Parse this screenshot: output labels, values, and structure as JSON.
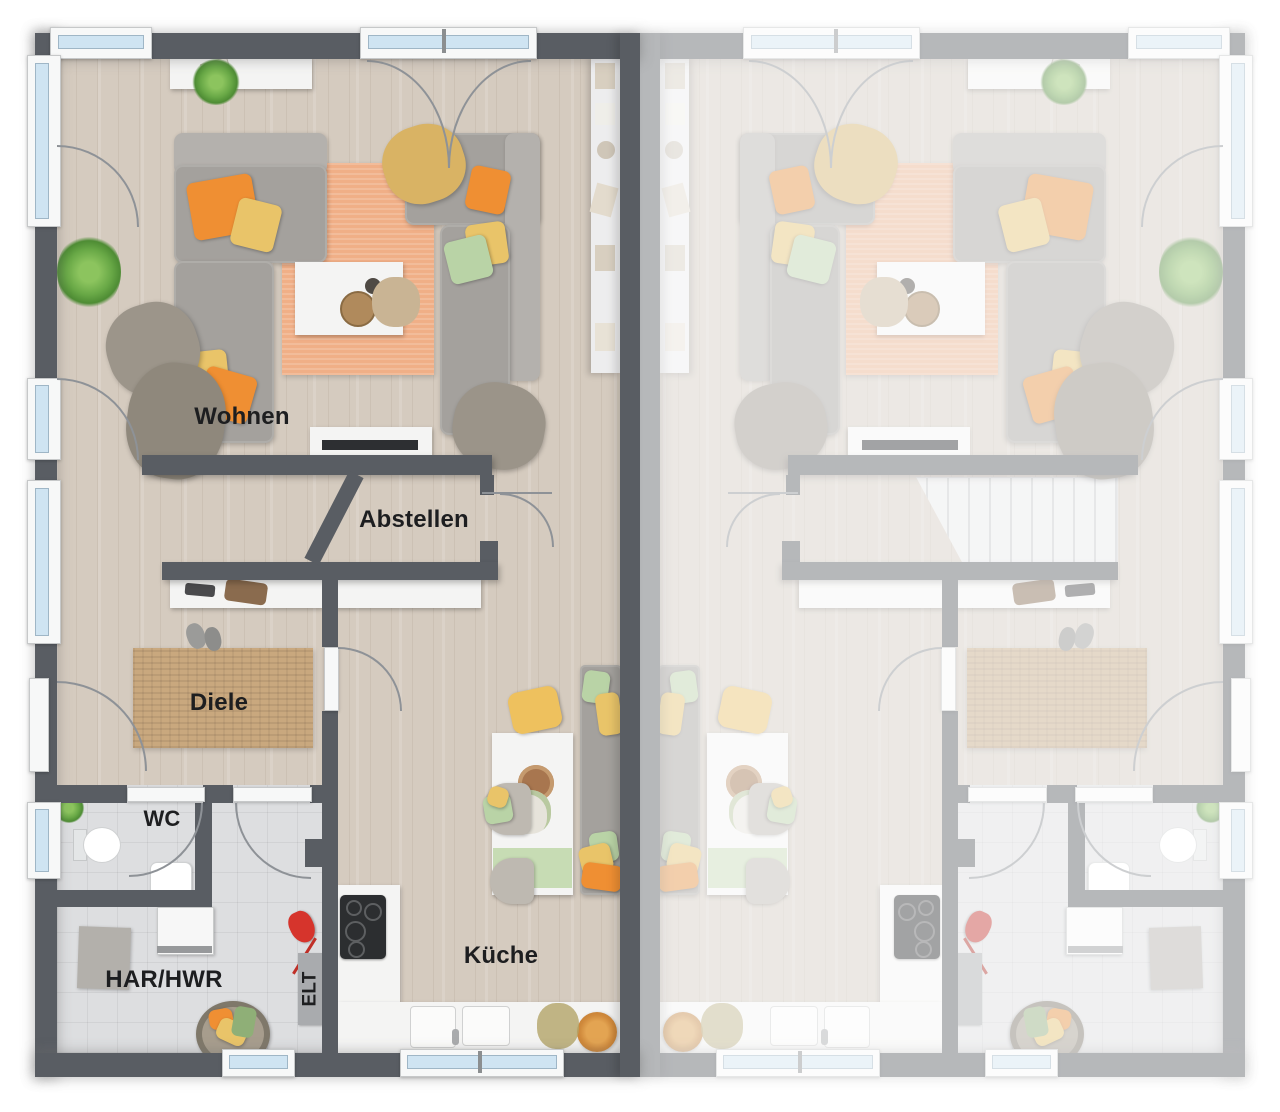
{
  "document": {
    "type": "residential floor plan, 3D rendered top view",
    "layout": "two mirrored semi-detached units; left unit rendered with labels, right unit mirrored and faded with staircase",
    "language": "de"
  },
  "rooms": {
    "living": "Wohnen",
    "storage": "Abstellen",
    "hallway": "Diele",
    "wc": "WC",
    "utility": "HAR/HWR",
    "electrical": "ELT",
    "kitchen": "Küche"
  },
  "palette": {
    "wall": "#595d63",
    "wall_faded": "#a9abae",
    "floor_wood": "#d5cbbf",
    "floor_tile": "#dddee0",
    "rug_living": "#f0af87",
    "rug_hall": "#c9a87e",
    "sofa": "#a4a19d",
    "pillow_orange": "#ef8f33",
    "pillow_yellow": "#e9c469",
    "pillow_green": "#b9d3a6",
    "blanket_tan": "#d9b364",
    "window_glass": "#cfe4f2",
    "counter_white": "#f4f4f3",
    "accent_red": "#d6342c",
    "plant_green": "#68a846"
  }
}
